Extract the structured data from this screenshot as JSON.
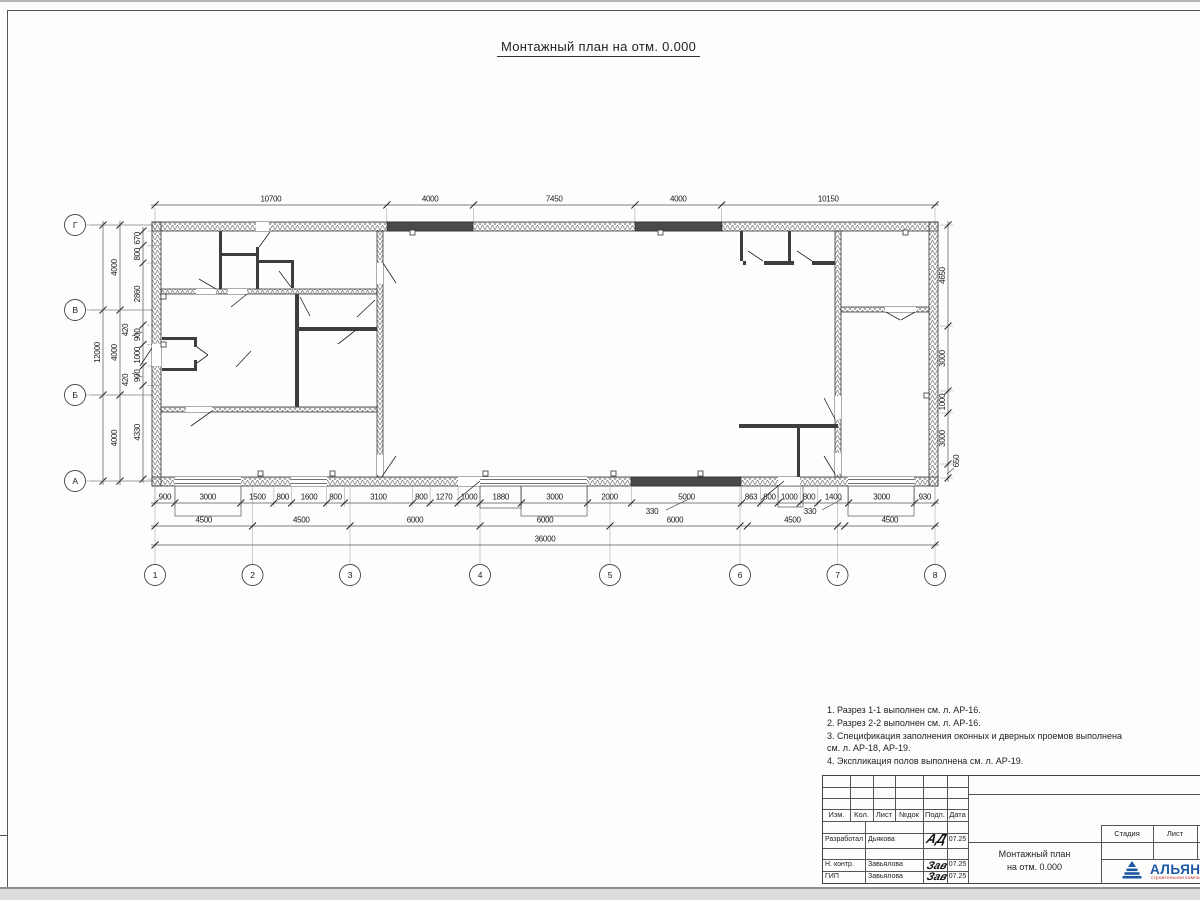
{
  "title": "Монтажный план на отм. 0.000",
  "notes": [
    "1. Разрез 1-1 выполнен см. л. АР-16.",
    "2. Разрез 2-2 выполнен см. л. АР-16.",
    "3. Спецификация заполнения оконных и дверных проемов выполнена",
    "см. л. АР-18, АР-19.",
    "4. Экспликация полов выполнена см. л. АР-19."
  ],
  "plan": {
    "axes_bottom": [
      {
        "label": "1",
        "x": 155
      },
      {
        "label": "2",
        "x": 252.5
      },
      {
        "label": "3",
        "x": 350
      },
      {
        "label": "4",
        "x": 480
      },
      {
        "label": "5",
        "x": 610
      },
      {
        "label": "6",
        "x": 740
      },
      {
        "label": "7",
        "x": 837.5
      },
      {
        "label": "8",
        "x": 935
      }
    ],
    "axes_left": [
      {
        "label": "Г",
        "y": 225
      },
      {
        "label": "В",
        "y": 310
      },
      {
        "label": "Б",
        "y": 395
      },
      {
        "label": "А",
        "y": 481
      }
    ],
    "dim_rows": [
      {
        "dir": "h",
        "y": 205,
        "ticks": [
          155,
          386.8,
          473.5,
          634.9,
          721.6,
          935
        ],
        "labels": [
          "10700",
          "4000",
          "7450",
          "4000",
          "10150"
        ]
      },
      {
        "dir": "h",
        "y": 503,
        "ticks": [
          155,
          174.8,
          240.8,
          273.9,
          291.5,
          326.7,
          344.3,
          412.5,
          430.1,
          458.1,
          480.1,
          521.5,
          587.5,
          631.5,
          741.6,
          760.6,
          778.2,
          800.2,
          817.8,
          848.6,
          914.6,
          935
        ],
        "labels": [
          "900",
          "3000",
          "1500",
          "800",
          "1600",
          "800",
          "3100",
          "800",
          "1270",
          "1000",
          "1880",
          "3000",
          "2000",
          "5000",
          "863",
          "800",
          "1000",
          "800",
          "1400",
          "3000",
          "930"
        ]
      },
      {
        "dir": "h",
        "y": 526,
        "ticks": [
          155,
          252.5,
          350,
          480,
          610,
          740,
          747.3,
          837.5,
          844.8,
          935
        ],
        "labels": [
          "4500",
          "4500",
          "6000",
          "6000",
          "6000",
          "",
          "4500",
          "",
          "4500"
        ]
      },
      {
        "dir": "h",
        "y": 545,
        "ticks": [
          155,
          935
        ],
        "labels": [
          "36000"
        ]
      },
      {
        "dir": "v",
        "x": 103,
        "ticks": [
          225,
          310,
          395,
          481
        ],
        "labels": [
          "",
          "12000",
          ""
        ]
      },
      {
        "dir": "v",
        "x": 120,
        "ticks": [
          225,
          310,
          395,
          481
        ],
        "labels": [
          "4000",
          "4000",
          "4000"
        ]
      },
      {
        "dir": "v",
        "x": 143,
        "ticks": [
          231,
          245.5,
          263,
          325,
          344.5,
          366,
          385.5,
          479
        ],
        "labels": [
          "670",
          "800",
          "2860",
          "900",
          "1000",
          "900",
          "4330"
        ]
      },
      {
        "dir": "v",
        "x": 948,
        "ticks": [
          225,
          326,
          391,
          413,
          464,
          478
        ],
        "labels": [
          "4650",
          "3000",
          "1000",
          "3000",
          ""
        ]
      }
    ],
    "special_labels": [
      {
        "t": "330",
        "x": 652,
        "y": 514,
        "rot": false,
        "leader": [
          666,
          510,
          689,
          499
        ]
      },
      {
        "t": "330",
        "x": 810,
        "y": 514,
        "rot": false,
        "leader": [
          822,
          510,
          842,
          499
        ]
      },
      {
        "t": "420",
        "x": 128,
        "y": 330,
        "rot": true,
        "leader": [
          132,
          336,
          142,
          332
        ]
      },
      {
        "t": "420",
        "x": 128,
        "y": 380,
        "rot": true,
        "leader": [
          132,
          373,
          142,
          377
        ]
      },
      {
        "t": "650",
        "x": 959,
        "y": 461,
        "rot": true,
        "leader": [
          954,
          468,
          947,
          474
        ]
      }
    ],
    "walls_hatched": [
      [
        152,
        222,
        786,
        9
      ],
      [
        152,
        477,
        786,
        9
      ],
      [
        152,
        222,
        9,
        264
      ],
      [
        929,
        222,
        9,
        264
      ],
      [
        377,
        231,
        6,
        246
      ],
      [
        161,
        289,
        216,
        5
      ],
      [
        161,
        407,
        216,
        5
      ],
      [
        835,
        231,
        6,
        246
      ],
      [
        841,
        307,
        88,
        5
      ]
    ],
    "walls_thin": [
      [
        219,
        231,
        3,
        58
      ],
      [
        219,
        253,
        39,
        3
      ],
      [
        256,
        247,
        3,
        42
      ],
      [
        258,
        260,
        36,
        3
      ],
      [
        291,
        260,
        3,
        28
      ],
      [
        295,
        294,
        4,
        113
      ],
      [
        299,
        327,
        78,
        4
      ],
      [
        162,
        337,
        35,
        3
      ],
      [
        194,
        340,
        3,
        7
      ],
      [
        194,
        360,
        3,
        11
      ],
      [
        162,
        368,
        35,
        3
      ],
      [
        740,
        231,
        3,
        30
      ],
      [
        788,
        231,
        3,
        30
      ],
      [
        743,
        261,
        92,
        4
      ],
      [
        739,
        424,
        99,
        4
      ],
      [
        797,
        428,
        3,
        49
      ]
    ],
    "gaps": [
      [
        196,
        289,
        20,
        5
      ],
      [
        228,
        289,
        19,
        5
      ],
      [
        186,
        407,
        26,
        5
      ],
      [
        377,
        263,
        6,
        21
      ],
      [
        377,
        455,
        6,
        20
      ],
      [
        835,
        396,
        6,
        23
      ],
      [
        835,
        453,
        6,
        21
      ],
      [
        746,
        261,
        18,
        4
      ],
      [
        794,
        261,
        18,
        4
      ],
      [
        885,
        307,
        31,
        5
      ],
      [
        152,
        344,
        9,
        22
      ],
      [
        256,
        222,
        13,
        9
      ],
      [
        175,
        477,
        66,
        9
      ],
      [
        291,
        477,
        36,
        9
      ],
      [
        458,
        477,
        63,
        9
      ],
      [
        521,
        477,
        66,
        9
      ],
      [
        778,
        477,
        22,
        9
      ],
      [
        848,
        477,
        66,
        9
      ]
    ],
    "dark_segments": [
      [
        387,
        222,
        86,
        9
      ],
      [
        635,
        222,
        87,
        9
      ],
      [
        631,
        477,
        110,
        9
      ]
    ],
    "porches": [
      [
        175,
        486,
        66,
        30
      ],
      [
        480,
        486,
        41,
        22
      ],
      [
        521,
        486,
        66,
        30
      ],
      [
        778,
        486,
        25,
        21
      ],
      [
        848,
        486,
        66,
        30
      ]
    ],
    "window_spans": [
      [
        175,
        241
      ],
      [
        291,
        327
      ],
      [
        480,
        521
      ],
      [
        521,
        587
      ],
      [
        848,
        914
      ]
    ],
    "pilasters": [
      [
        258,
        471
      ],
      [
        330,
        471
      ],
      [
        483,
        471
      ],
      [
        611,
        471
      ],
      [
        698,
        471
      ],
      [
        410,
        230
      ],
      [
        658,
        230
      ],
      [
        903,
        230
      ],
      [
        161,
        294
      ],
      [
        161,
        342
      ],
      [
        924,
        393
      ]
    ],
    "doors": [
      [
        259,
        247,
        270,
        232
      ],
      [
        291,
        287,
        279,
        271
      ],
      [
        216,
        289,
        199,
        279
      ],
      [
        247,
        294,
        231,
        307
      ],
      [
        300,
        297,
        310,
        316
      ],
      [
        356,
        330,
        338,
        344
      ],
      [
        375,
        300,
        357,
        317
      ],
      [
        383,
        263,
        396,
        283
      ],
      [
        383,
        475,
        396,
        456
      ],
      [
        152,
        348,
        140,
        366
      ],
      [
        197,
        347,
        208,
        355
      ],
      [
        197,
        363,
        208,
        355
      ],
      [
        236,
        367,
        251,
        351
      ],
      [
        763,
        261,
        748,
        251
      ],
      [
        812,
        261,
        797,
        251
      ],
      [
        886,
        312,
        900,
        320
      ],
      [
        915,
        312,
        901,
        320
      ],
      [
        835,
        419,
        824,
        398
      ],
      [
        835,
        474,
        824,
        456
      ],
      [
        480,
        481,
        457,
        500
      ],
      [
        784,
        481,
        761,
        500
      ],
      [
        212,
        411,
        191,
        426
      ]
    ]
  },
  "titleblock": {
    "header": [
      "Изм.",
      "Кол.",
      "Лист",
      "№док",
      "Подп.",
      "Дата"
    ],
    "rows": [
      {
        "role": "Разработал",
        "name": "Дьякова",
        "sig": "АД",
        "date": "07.25"
      },
      {
        "role": "Н. контр.",
        "name": "Завьялова",
        "sig": "Зав",
        "date": "07.25"
      },
      {
        "role": "ГИП",
        "name": "Завьялова",
        "sig": "Зав",
        "date": "07.25"
      }
    ],
    "doc_title_line1": "Монтажный план",
    "doc_title_line2": "на отм. 0.000",
    "stage_headers": [
      "Стадия",
      "Лист",
      "Листов"
    ],
    "org": {
      "name": "АЛЬЯНС",
      "tagline": "строительная компания"
    },
    "accent_blue": "#1c57a5",
    "accent_red": "#c03028"
  }
}
